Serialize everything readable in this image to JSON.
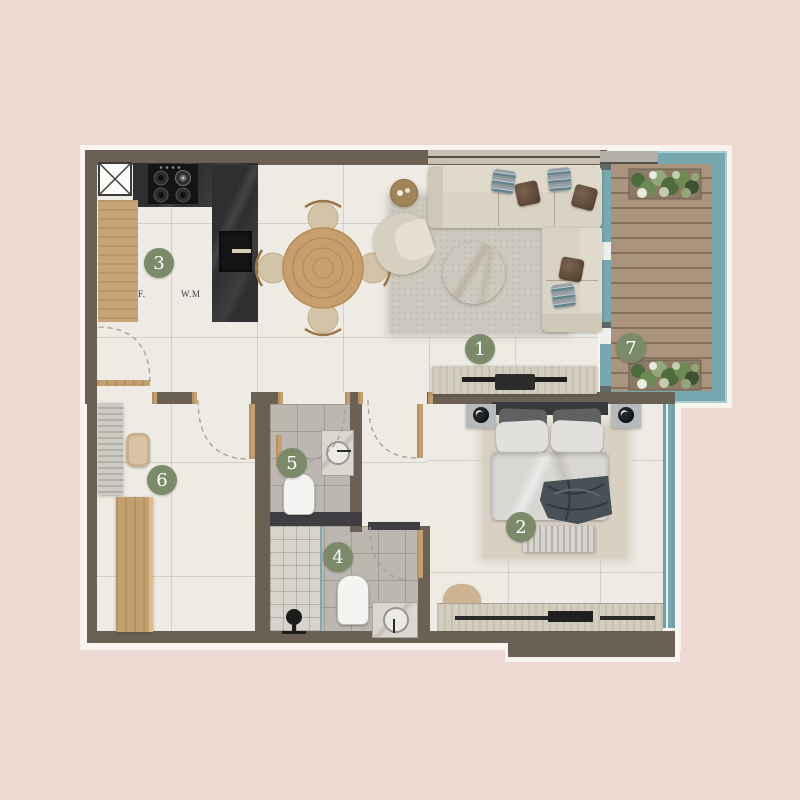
{
  "plan": {
    "type": "apartment-floor-plan",
    "rooms": [
      {
        "number": "1",
        "name": "living-room"
      },
      {
        "number": "2",
        "name": "bedroom"
      },
      {
        "number": "3",
        "name": "kitchen"
      },
      {
        "number": "4",
        "name": "bathroom"
      },
      {
        "number": "5",
        "name": "wc"
      },
      {
        "number": "6",
        "name": "hallway"
      },
      {
        "number": "7",
        "name": "balcony"
      }
    ],
    "appliance_labels": {
      "fridge": "F.",
      "washing_machine": "W.M"
    }
  },
  "colors": {
    "background": "#edd9d1",
    "wall": "#6a6154",
    "floor_tile": "#edebe4",
    "bath_tile": "#bcb7b1",
    "wood": "#c8a576",
    "counter_dark_marble": "#2f2e30",
    "balcony_deck": "#ab947d",
    "glass_teal": "#77a8b0",
    "marker_green": "#7b8a68",
    "plan_outline": "#f9f3ee"
  }
}
